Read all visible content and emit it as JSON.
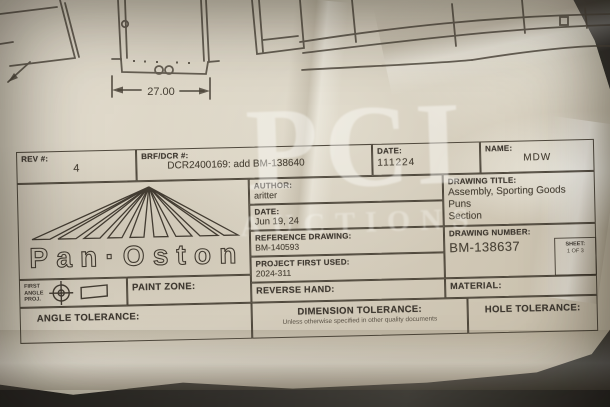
{
  "watermark": {
    "line1": "PCI",
    "line2": "AUCTIONS"
  },
  "top_drawing": {
    "dimension": "27.00"
  },
  "logo": {
    "brand": "Pan·Oston"
  },
  "title_block": {
    "rev": {
      "label": "REV #:",
      "value": "4"
    },
    "brf_dcr": {
      "label": "BRF/DCR #:",
      "value": "DCR2400169: add BM-138640"
    },
    "date_top": {
      "label": "DATE:",
      "value": "111224"
    },
    "name": {
      "label": "NAME:",
      "value": "MDW"
    },
    "author": {
      "label": "AUTHOR:",
      "value": "aritter"
    },
    "date_author": {
      "label": "DATE:",
      "value": "Jun 19, 24"
    },
    "reference_drawing": {
      "label": "REFERENCE DRAWING:",
      "value": "BM-140593"
    },
    "project_first_used": {
      "label": "PROJECT FIRST USED:",
      "value": "2024-311"
    },
    "reverse_hand": {
      "label": "REVERSE HAND:"
    },
    "drawing_title": {
      "label": "DRAWING TITLE:",
      "line1": "Assembly, Sporting Goods Puns",
      "line2": "Section"
    },
    "drawing_number": {
      "label": "DRAWING NUMBER:",
      "value": "BM-138637"
    },
    "sheet": {
      "label": "SHEET:",
      "value": "1 OF 3"
    },
    "material": {
      "label": "MATERIAL:"
    },
    "first_angle_projection": {
      "line1": "FIRST",
      "line2": "ANGLE",
      "line3": "PROJ."
    },
    "paint_zone": {
      "label": "PAINT ZONE:"
    },
    "angle_tolerance": {
      "label": "ANGLE TOLERANCE:"
    },
    "dimension_tolerance": {
      "label": "DIMENSION TOLERANCE:",
      "note": "Unless otherwise specified in other quality documents"
    },
    "hole_tolerance": {
      "label": "HOLE TOLERANCE:"
    }
  },
  "colors": {
    "paper": "#d8d1c1",
    "ink": "#423c33",
    "surface": "#26241f",
    "watermark": "rgba(255,255,252,0.42)"
  }
}
